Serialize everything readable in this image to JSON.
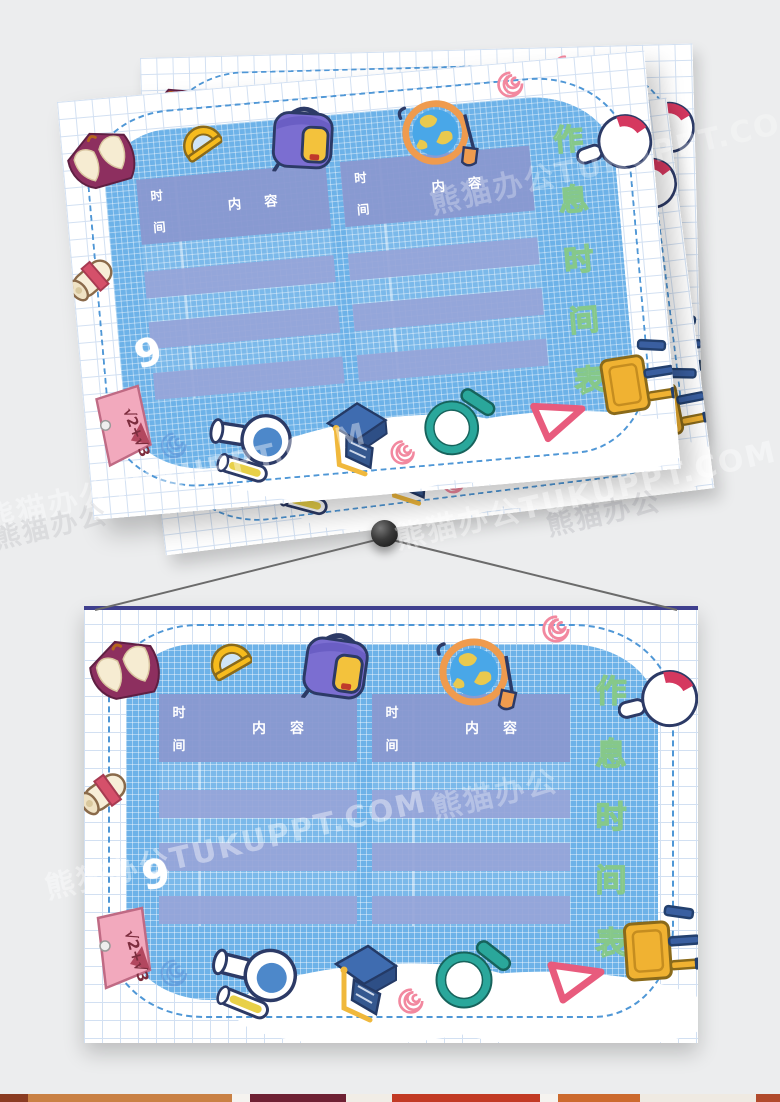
{
  "page": {
    "background_color": "#ecedee"
  },
  "watermark": {
    "text": "熊猫办公TUKUPPT.COM",
    "short_text": "熊猫办公"
  },
  "card": {
    "title_text": "作息时间表",
    "title_chars": [
      "作",
      "息",
      "时",
      "间",
      "表"
    ],
    "tables": [
      {
        "time_header_chars": [
          "时",
          "间"
        ],
        "content_header_chars": [
          "内",
          "容"
        ],
        "rows": [
          "",
          "",
          ""
        ]
      },
      {
        "time_header_chars": [
          "时",
          "间"
        ],
        "content_header_chars": [
          "内",
          "容"
        ],
        "rows": [
          "",
          "",
          ""
        ]
      }
    ],
    "note_formula": "√2+√3",
    "nine_doodle": "9",
    "icons": [
      "open-book",
      "protractor",
      "backpack",
      "globe",
      "round-flask",
      "diploma-scroll",
      "sticky-note",
      "pink-spiral",
      "blue-spiral",
      "flask-with-tube",
      "graduation-cap",
      "magnifier",
      "set-square",
      "stool",
      "pink-spiral-2"
    ],
    "colors": {
      "blob": "#6db2e8",
      "paper_grid": "#d2e0f2",
      "table_fill": "#8998d0",
      "title_fill": "#ffffff",
      "title_outline": "#86c88a",
      "dashed_border": "#4f97d6",
      "hanger_bar": "#3f3f8e"
    }
  },
  "bottom_strip": {
    "segments": [
      {
        "color": "#8a3c22",
        "width": 28
      },
      {
        "color": "#c98144",
        "width": 204
      },
      {
        "color": "#f5f3ef",
        "width": 18
      },
      {
        "color": "#6e2133",
        "width": 96
      },
      {
        "color": "#f1ede6",
        "width": 46
      },
      {
        "color": "#c23a24",
        "width": 148
      },
      {
        "color": "#f5f3ef",
        "width": 18
      },
      {
        "color": "#cc6a2e",
        "width": 82
      },
      {
        "color": "#efeae2",
        "width": 116
      },
      {
        "color": "#b14a2c",
        "width": 24
      }
    ]
  }
}
